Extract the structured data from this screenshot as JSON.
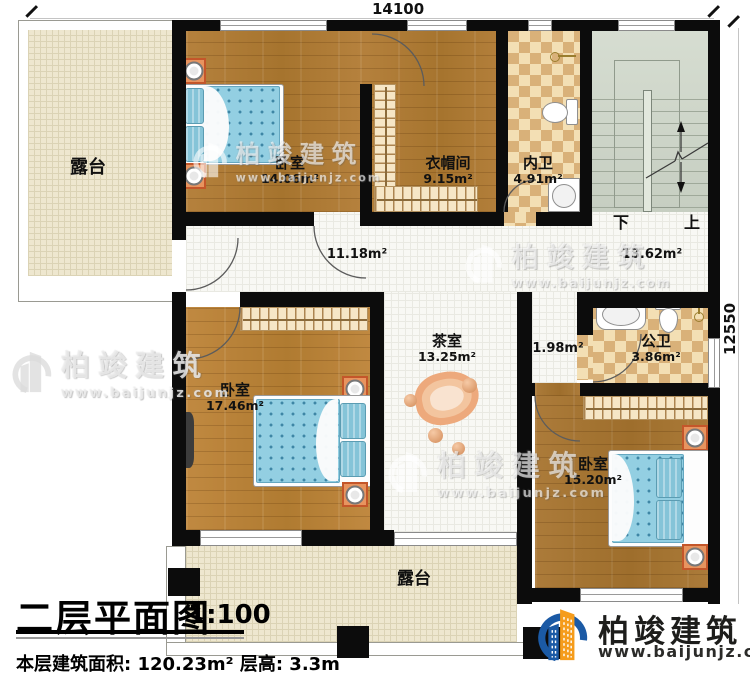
{
  "dimensions": {
    "top": "14100",
    "right": "12550"
  },
  "title": {
    "name": "二层平面图",
    "scale": "1:100",
    "stats": "本层建筑面积: 120.23m²  层高: 3.3m"
  },
  "logo": {
    "name": "柏竣建筑",
    "url": "www.baijunjz.com"
  },
  "watermark": {
    "name": "柏竣建筑",
    "url": "www.baijunjz.com"
  },
  "stairs": {
    "down": "下",
    "up": "上"
  },
  "rooms": {
    "terrace_top": {
      "label": "露台"
    },
    "bedroom1": {
      "label": "卧室",
      "area": "14.06m²"
    },
    "closet": {
      "label": "衣帽间",
      "area": "9.15m²"
    },
    "inner_bath": {
      "label": "内卫",
      "area": "4.91m²"
    },
    "corridor": {
      "area": "11.18m²"
    },
    "stair_hall": {
      "area": "13.62m²"
    },
    "bedroom2": {
      "label": "卧室",
      "area": "17.46m²"
    },
    "tea_room": {
      "label": "茶室",
      "area": "13.25m²"
    },
    "vestibule": {
      "area": "1.98m²"
    },
    "public_bath": {
      "label": "公卫",
      "area": "3.86m²"
    },
    "bedroom3": {
      "label": "卧室",
      "area": "15.20m²"
    },
    "terrace_bottom": {
      "label": "露台"
    }
  },
  "colors": {
    "wall": "#0c0c0c",
    "wood": "#b07c36",
    "terrace": "#eee7cf",
    "checker": "#d9b179",
    "stair": "#ced6c9",
    "bed": "#93cfe2",
    "logo_blue": "#1b5aa5",
    "logo_orange": "#f59c1c"
  }
}
